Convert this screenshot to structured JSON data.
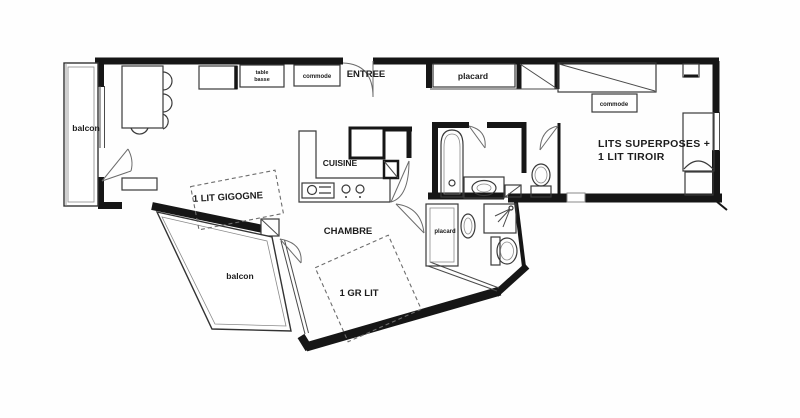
{
  "plan": {
    "labels": {
      "balcony_left": "balcon",
      "coffee_table_line1": "table",
      "coffee_table_line2": "basse",
      "dresser_top": "commode",
      "entrance": "ENTREE",
      "closet_top": "placard",
      "dresser_right": "commode",
      "bunk_beds_line1": "LITS SUPERPOSES +",
      "bunk_beds_line2": "1 LIT TIROIR",
      "kitchen": "CUISINE",
      "trundle_bed": "1 LIT GIGOGNE",
      "bedroom": "CHAMBRE",
      "closet_mid": "placard",
      "balcony_bottom": "balcon",
      "double_bed": "1 GR LIT"
    },
    "colors": {
      "wall": "#161616",
      "accent_blue": "#55809b",
      "accent_brown": "#8a7355",
      "label": "#1c1c1c"
    }
  }
}
